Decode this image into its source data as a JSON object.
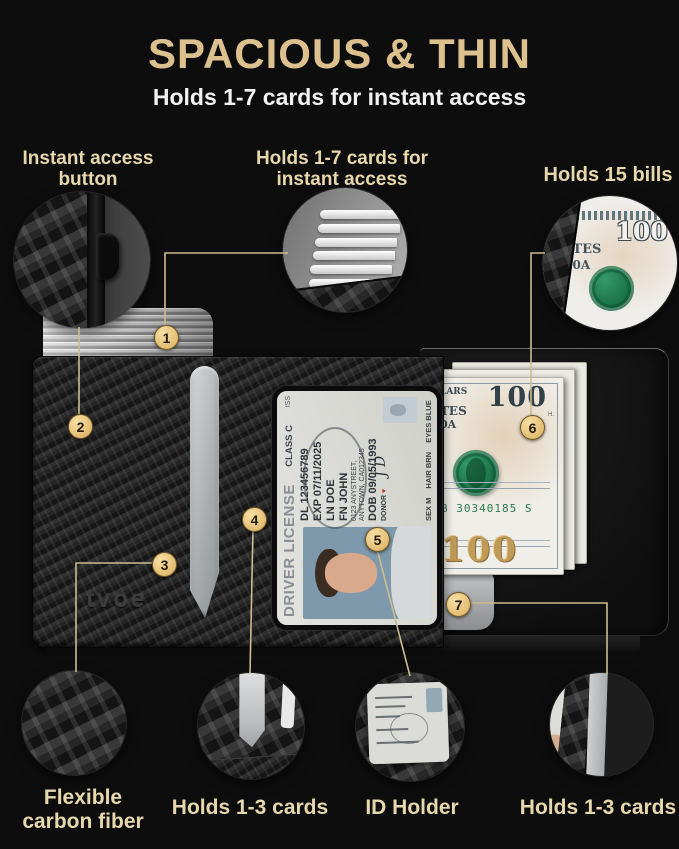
{
  "header": {
    "title": "SPACIOUS & THIN",
    "subtitle": "Holds 1-7 cards for instant access"
  },
  "colors": {
    "background": "#0d0d0d",
    "title_gold": "#dcc18f",
    "label_cream": "#e7d7ad",
    "marker_gold": "#e3bd72",
    "leader_line": "#cdbc90",
    "seal_green": "#1b7348",
    "serial_green": "#2f7a50"
  },
  "callouts": {
    "instant_access_button": {
      "line1": "Instant access",
      "line2": "button"
    },
    "holds_1_7_cards": {
      "line1": "Holds 1-7 cards for",
      "line2": "instant access"
    },
    "holds_15_bills": {
      "label": "Holds 15 bills"
    },
    "flexible_carbon_fiber": {
      "line1": "Flexible",
      "line2": "carbon fiber"
    },
    "holds_1_3_cards_left": {
      "label": "Holds 1-3 cards"
    },
    "id_holder": {
      "label": "ID Holder"
    },
    "holds_1_3_cards_right": {
      "label": "Holds 1-3 cards"
    }
  },
  "markers": {
    "m1": "1",
    "m2": "2",
    "m3": "3",
    "m4": "4",
    "m5": "5",
    "m6": "6",
    "m7": "7"
  },
  "product": {
    "logo_text": "tvoe",
    "id_card": {
      "header": "DRIVER LICENSE",
      "class": "CLASS C",
      "iss": "ISS",
      "dl": "DL 123456789",
      "exp": "EXP 07/11/2025",
      "ln": "LN DOE",
      "fn": "FN JOHN",
      "address1": "0123 ANYSTREET,",
      "address2": "ANYTOWN, CA012345",
      "dob": "DOB 09/05/1993",
      "donor": "DONOR",
      "donor_heart": "♥",
      "sex": "SEX M",
      "hair": "HAIR BRN",
      "eyes": "EYES BLUE",
      "signature": "J D"
    },
    "bill": {
      "denomination_top": "100",
      "denomination_bottom": "100",
      "serial": "B 30340185 S",
      "partial_text_1": "LARS",
      "partial_text_2": "TES",
      "partial_text_3": "0A",
      "mark": "H."
    },
    "inset_bill": {
      "denomination": "100"
    }
  }
}
